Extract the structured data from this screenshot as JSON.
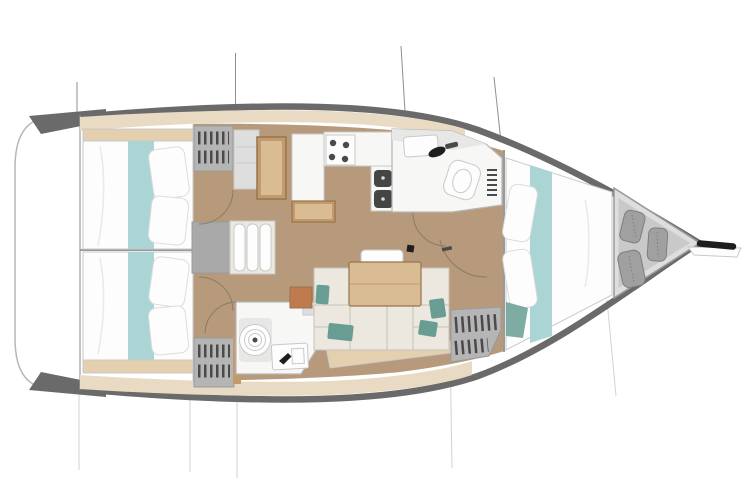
{
  "figure": {
    "type": "yacht-interior-floor-plan",
    "orientation": "bow-right",
    "features": [
      "transom",
      "aft-cabin-port",
      "aft-cabin-starboard",
      "hanging-lockers",
      "companionway-steps",
      "chart-table",
      "galley",
      "stove-burners",
      "galley-sinks",
      "aft-head",
      "toilet",
      "bathroom-sink",
      "saloon-settee",
      "accent-cushions",
      "saloon-table",
      "storage-louvers",
      "forward-head",
      "head-sink",
      "forward-cabin-vberth",
      "anchor-locker",
      "fenders",
      "bowsprit",
      "rigging-lines"
    ]
  },
  "palette": {
    "page_bg": "#ffffff",
    "hull_white": "#ffffff",
    "outline_gray": "#b7b7b7",
    "hull_band": "#6a6a6a",
    "deck_tan": "#e9dbc3",
    "floor_wood": "#b69a7b",
    "wood": "#c49a6c",
    "wood_dark": "#96744e",
    "wood_light": "#d9bb94",
    "teal": "#abd5d4",
    "teal_dark": "#679d92",
    "white_surface": "#f7f7f5",
    "bed_white": "#fdfdfd",
    "soft_gray": "#c9c9c9",
    "pillow_stroke": "#dcdcdc",
    "mid_gray": "#9a9a9a",
    "locker_gray": "#b5b5b5",
    "bar_dark": "#4a4a4a",
    "steps_gray": "#a9a9a9",
    "cushion_beige": "#ece8df",
    "cushion_stroke": "#c5c2b9",
    "plinth_tan": "#e4d0ae",
    "orange_wood": "#bf7b4e",
    "fender_gray": "#a0a0a0",
    "fender_dark": "#7e7e7e",
    "anchor_gray": "#dedede",
    "anchor_inner": "#c9c9c9",
    "black": "#1e1e1e",
    "sink_dark": "#454545",
    "arc_brown": "#8d7b63",
    "faint_line": "#d2d2d2",
    "rig_line": "#8f8f8f",
    "fold_gray": "#e9e9e7",
    "shade_gray": "#e7e7e5",
    "dot_light": "#d8d8d8"
  }
}
